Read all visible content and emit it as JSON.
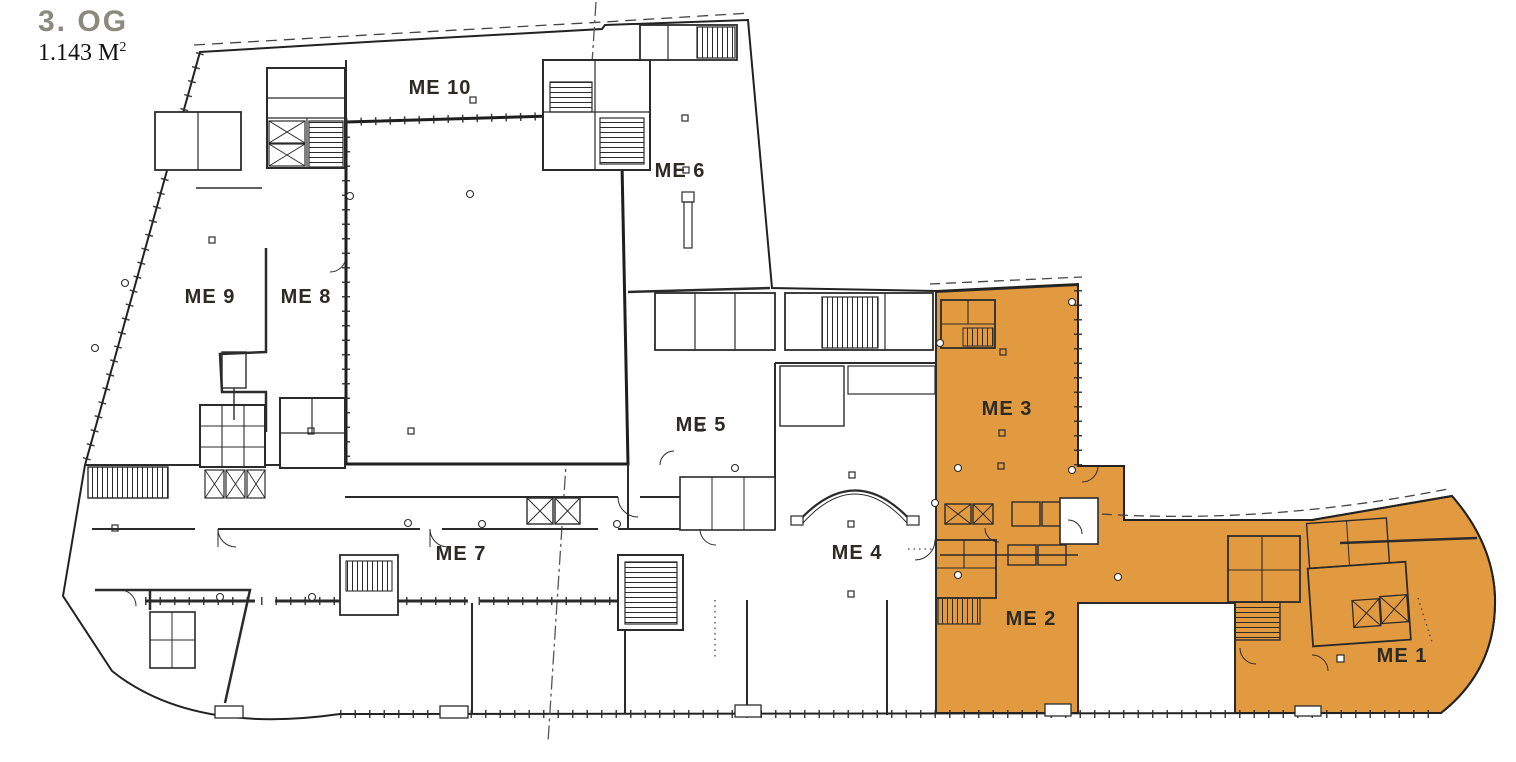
{
  "header": {
    "title": "3. OG",
    "area_value": "1.143 M",
    "area_exponent": "2"
  },
  "units": [
    {
      "id": "me1",
      "label": "ME 1",
      "x": 1402,
      "y": 655,
      "highlighted": true
    },
    {
      "id": "me2",
      "label": "ME 2",
      "x": 1031,
      "y": 618,
      "highlighted": true
    },
    {
      "id": "me3",
      "label": "ME 3",
      "x": 1007,
      "y": 408,
      "highlighted": true
    },
    {
      "id": "me4",
      "label": "ME 4",
      "x": 857,
      "y": 552,
      "highlighted": false
    },
    {
      "id": "me5",
      "label": "ME 5",
      "x": 701,
      "y": 424,
      "highlighted": false
    },
    {
      "id": "me6",
      "label": "ME 6",
      "x": 680,
      "y": 170,
      "highlighted": false
    },
    {
      "id": "me7",
      "label": "ME 7",
      "x": 461,
      "y": 553,
      "highlighted": false
    },
    {
      "id": "me8",
      "label": "ME 8",
      "x": 306,
      "y": 296,
      "highlighted": false
    },
    {
      "id": "me9",
      "label": "ME 9",
      "x": 210,
      "y": 296,
      "highlighted": false
    },
    {
      "id": "me10",
      "label": "ME 10",
      "x": 440,
      "y": 87,
      "highlighted": false
    }
  ],
  "colors": {
    "highlight": "#E29A41",
    "title": "#8B8B7D",
    "plan_line": "#2B2B2B",
    "label_text": "#2D2A24"
  }
}
